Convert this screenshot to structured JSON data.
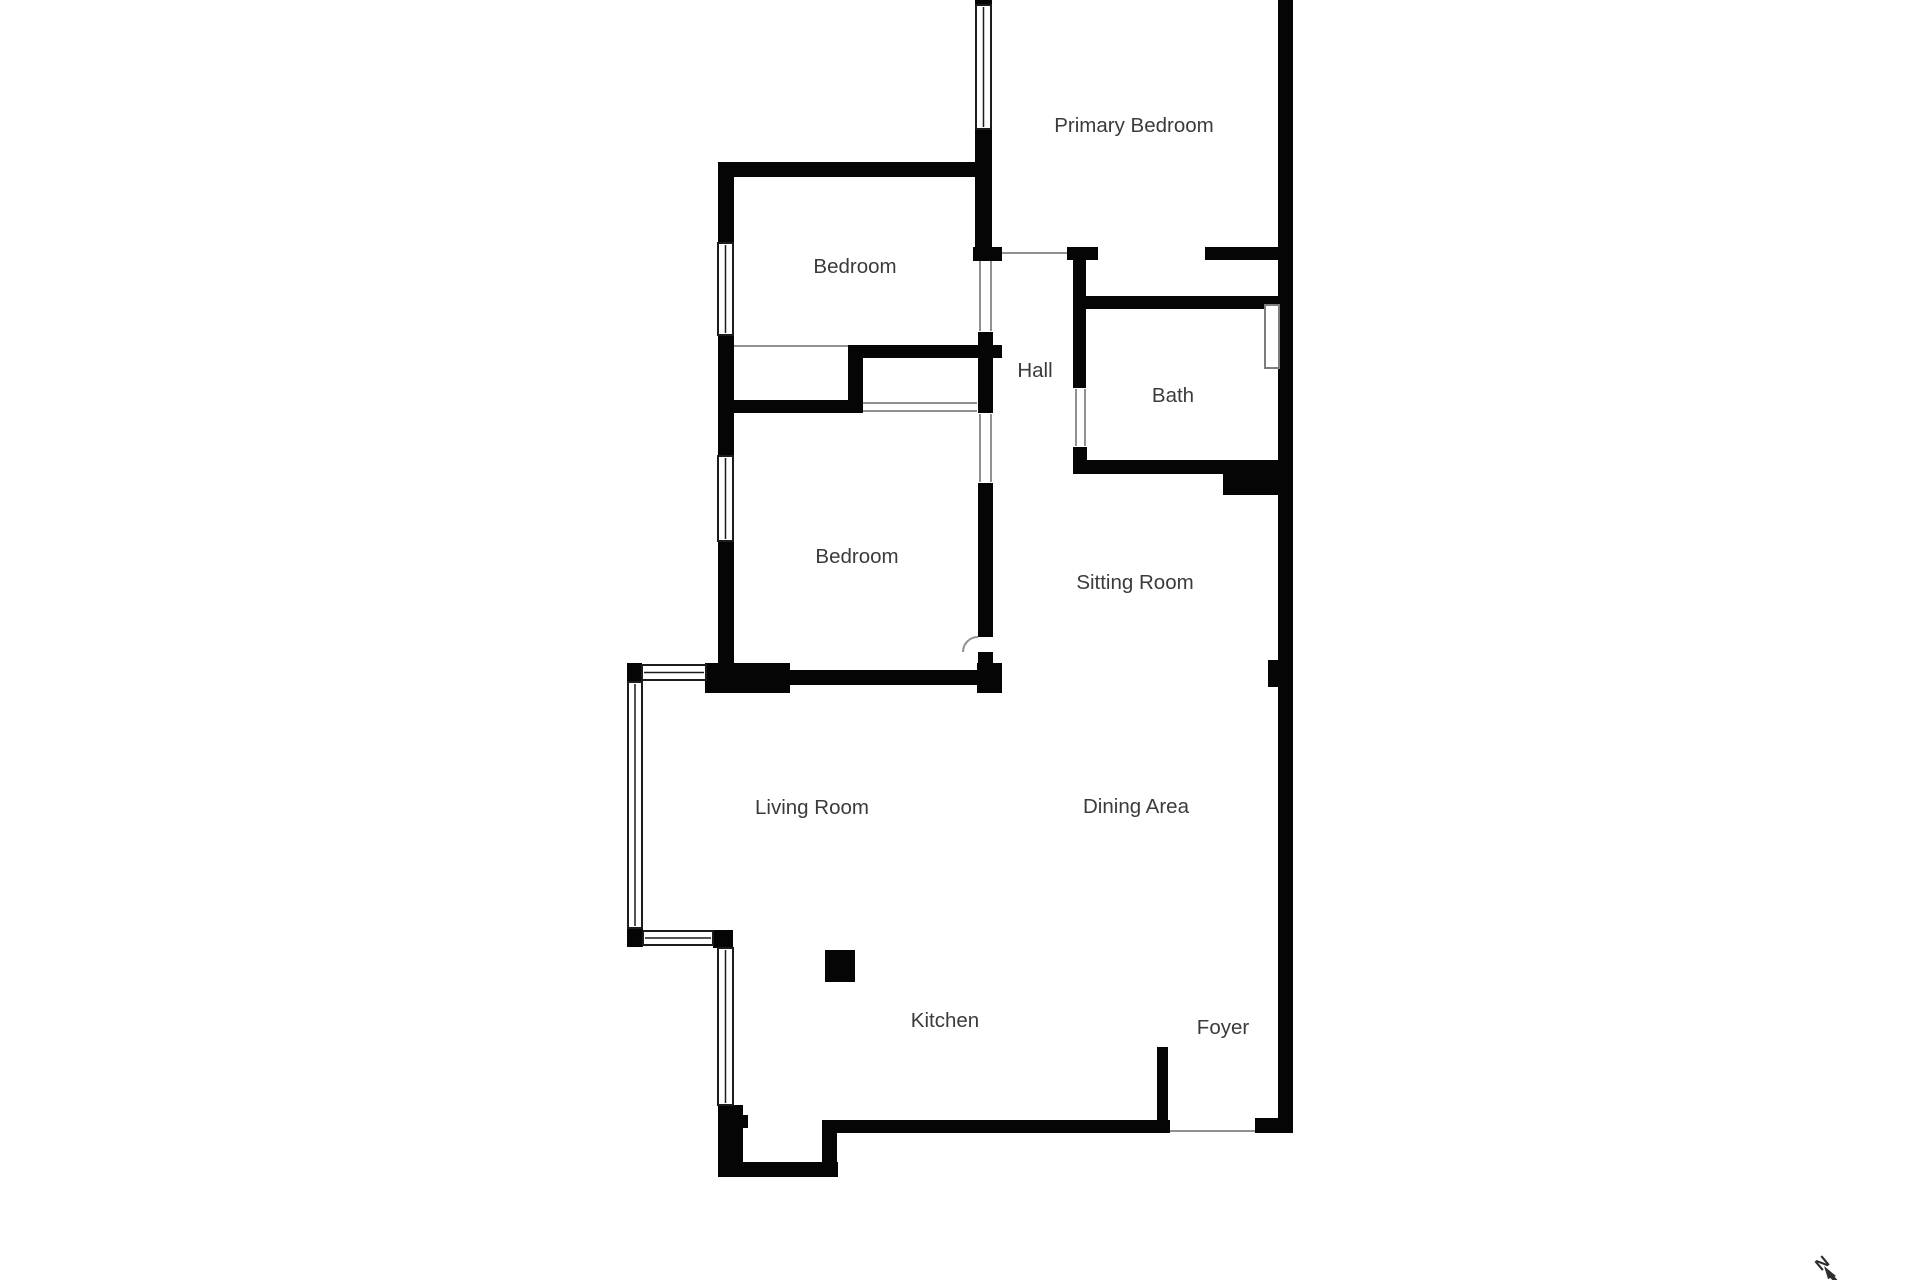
{
  "page": {
    "background": "#ffffff"
  },
  "colors": {
    "wall": "#050505",
    "label": "#3b3b3b",
    "door_line": "#919191",
    "window_outline": "#1c1c1c",
    "fixture_outline": "#7d7d7d",
    "compass": "#2e2e2e"
  },
  "rooms": [
    {
      "name": "Primary Bedroom"
    },
    {
      "name": "Bedroom"
    },
    {
      "name": "Hall"
    },
    {
      "name": "Bath"
    },
    {
      "name": "Bedroom"
    },
    {
      "name": "Sitting Room"
    },
    {
      "name": "Living Room"
    },
    {
      "name": "Dining Area"
    },
    {
      "name": "Kitchen"
    },
    {
      "name": "Foyer"
    }
  ],
  "compass": {
    "north_label": "N"
  }
}
